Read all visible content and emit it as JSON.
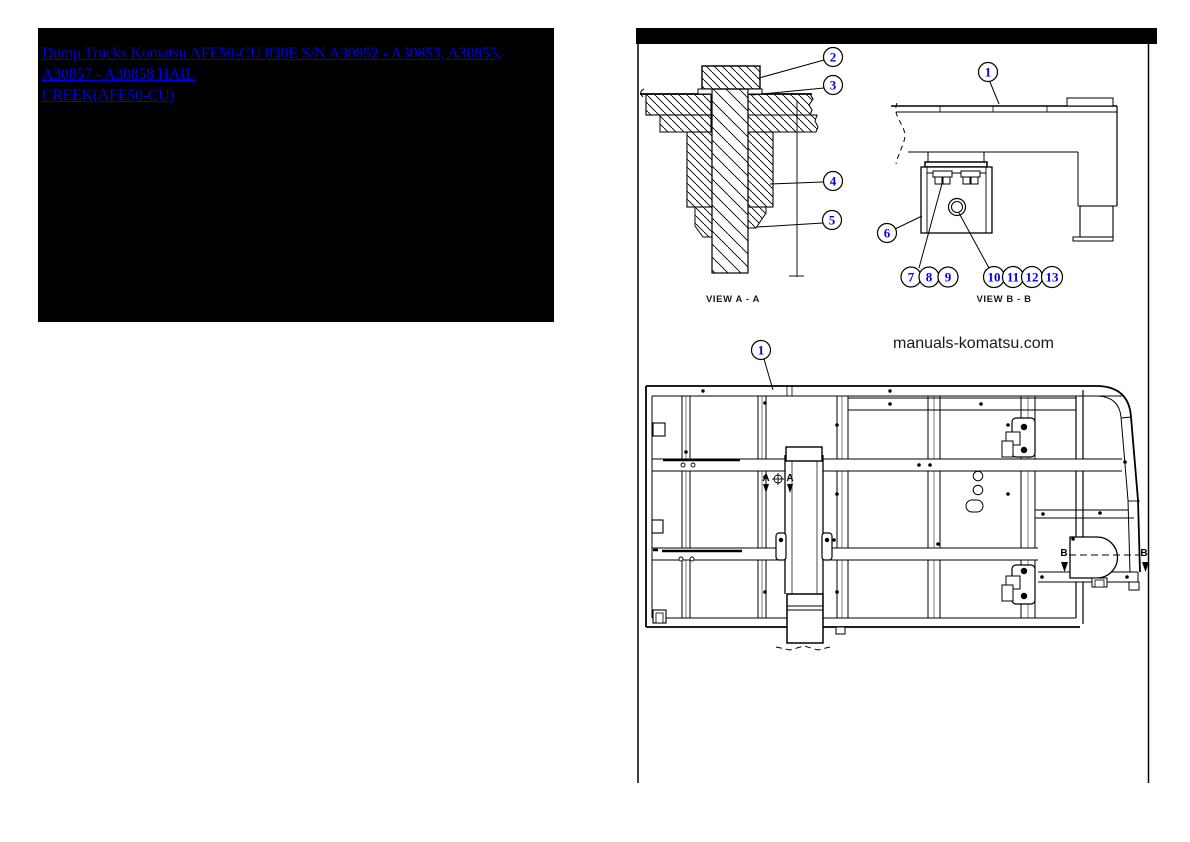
{
  "header": {
    "box_background": "#000000",
    "link_color": "#0000ee",
    "link_line1": "Dump Trucks Komatsu AFE50-CU 830E  S/N A30852 - A30853, A30855, A30857 - A30858 HAIL",
    "link_line2": "CREEK(AFE50-CU)"
  },
  "diagram": {
    "watermark": "manuals-komatsu.com",
    "view_a_label": "VIEW A - A",
    "view_b_label": "VIEW B - B",
    "section_a": "A",
    "section_b": "B",
    "line_color": "#000000",
    "callout_number_color": "#0000ee",
    "callouts": {
      "n1": "1",
      "n2": "2",
      "n3": "3",
      "n4": "4",
      "n5": "5",
      "n6": "6",
      "n7": "7",
      "n8": "8",
      "n9": "9",
      "n10": "10",
      "n11": "11",
      "n12": "12",
      "n13": "13"
    }
  }
}
